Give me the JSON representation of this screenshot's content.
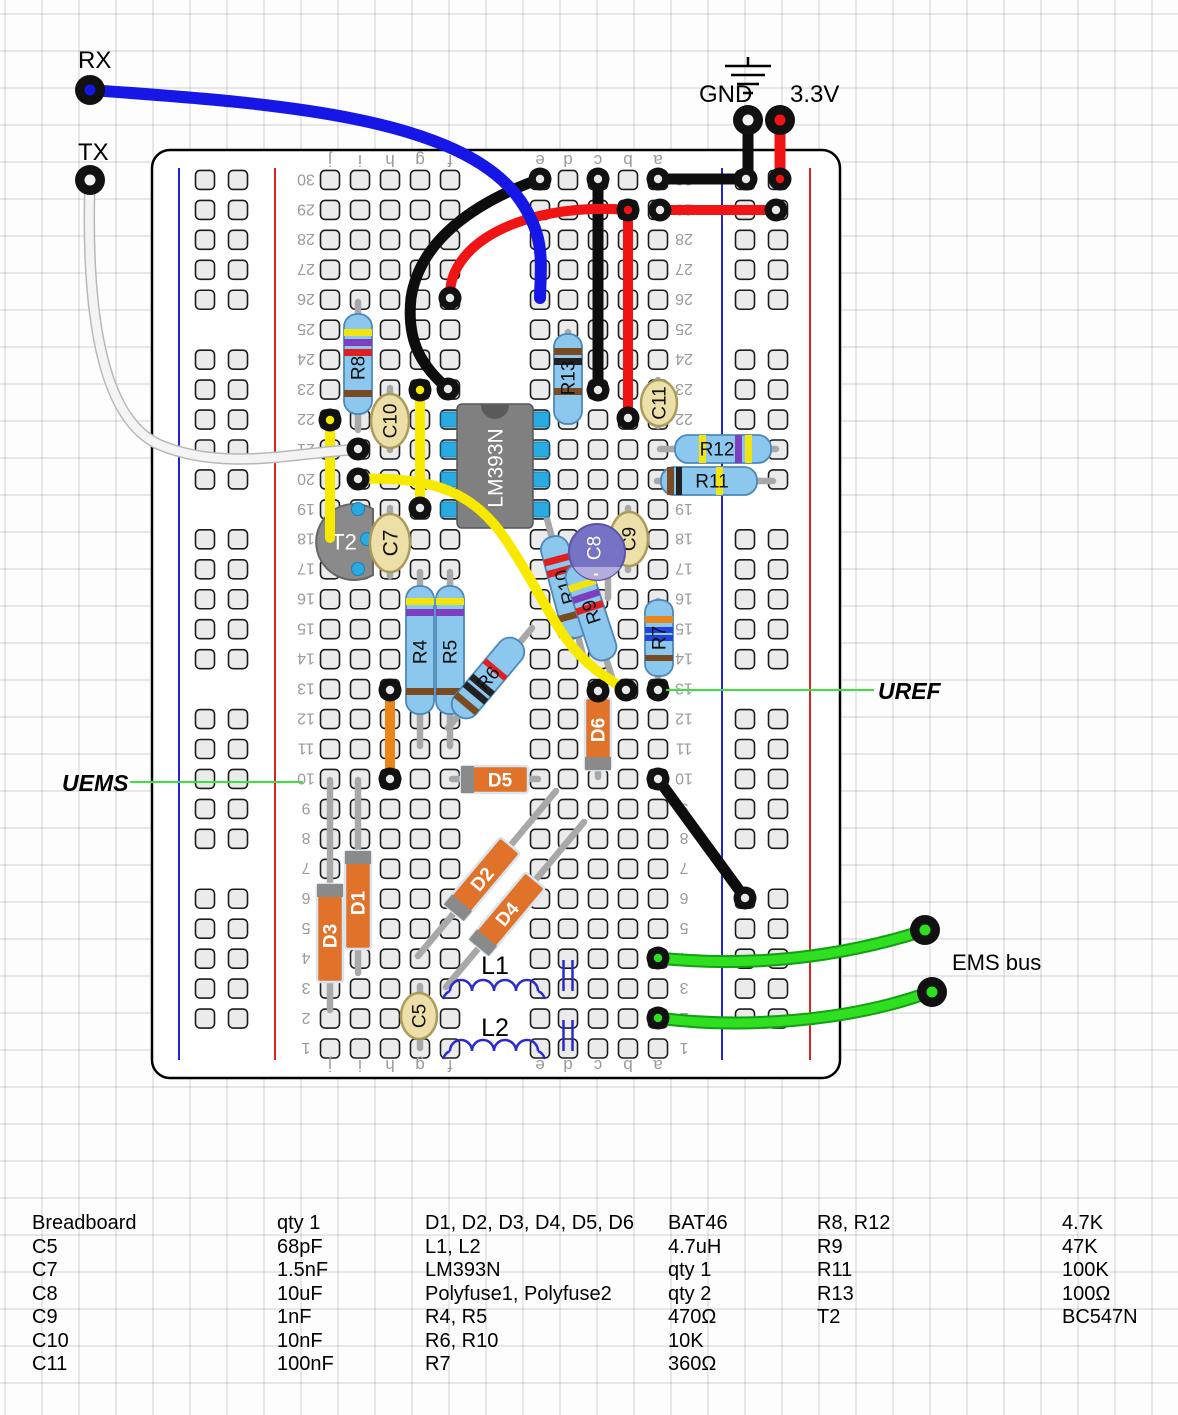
{
  "labels": {
    "rx": "RX",
    "tx": "TX",
    "gnd": "GND",
    "v33": "3.3V",
    "uref": "UREF",
    "uems": "UEMS",
    "ems_bus": "EMS bus"
  },
  "board": {
    "column_letters": [
      "j",
      "i",
      "h",
      "g",
      "f",
      "e",
      "d",
      "c",
      "b",
      "a"
    ],
    "row_count": 30
  },
  "components": {
    "R4": "R4",
    "R5": "R5",
    "R6": "R6",
    "R7": "R7",
    "R8": "R8",
    "R9": "R9",
    "R10": "R10",
    "R11": "R11",
    "R12": "R12",
    "R13": "R13",
    "C5": "C5",
    "C7": "C7",
    "C8": "C8",
    "C9": "C9",
    "C10": "C10",
    "C11": "C11",
    "D1": "D1",
    "D2": "D2",
    "D3": "D3",
    "D4": "D4",
    "D5": "D5",
    "D6": "D6",
    "L1": "L1",
    "L2": "L2",
    "T2": "T2",
    "IC": "LM393N",
    "minus": "-"
  },
  "colors": {
    "wire_blue": "#1616e6",
    "wire_black": "#0d0d0d",
    "wire_red": "#f01414",
    "wire_white": "#f4f4f4",
    "wire_yellow": "#f7ea00",
    "wire_green": "#2ee01f",
    "wire_orange": "#ea8618",
    "callout_line_green": "#3ae23a",
    "resistor_body": "#8cc7ee",
    "diode_body": "#e0722a",
    "cap_tan": "#ece0a8",
    "cap_electrolytic": "#7672c4",
    "ic_body": "#808080",
    "ic_pin": "#29abe2"
  },
  "parts_list": {
    "left": [
      {
        "name": "Breadboard",
        "value": "qty 1"
      },
      {
        "name": "C5",
        "value": "68pF"
      },
      {
        "name": "C7",
        "value": "1.5nF"
      },
      {
        "name": "C8",
        "value": "10uF"
      },
      {
        "name": "C9",
        "value": "1nF"
      },
      {
        "name": "C10",
        "value": "10nF"
      },
      {
        "name": "C11",
        "value": "100nF"
      }
    ],
    "middle": [
      {
        "name": "D1, D2, D3, D4, D5, D6",
        "value": "BAT46"
      },
      {
        "name": "L1, L2",
        "value": "4.7uH"
      },
      {
        "name": "LM393N",
        "value": "qty 1"
      },
      {
        "name": "Polyfuse1, Polyfuse2",
        "value": "qty 2"
      },
      {
        "name": "R4, R5",
        "value": "470Ω"
      },
      {
        "name": "R6, R10",
        "value": "10K"
      },
      {
        "name": "R7",
        "value": "360Ω"
      }
    ],
    "right": [
      {
        "name": "R8, R12",
        "value": "4.7K"
      },
      {
        "name": "R9",
        "value": "47K"
      },
      {
        "name": "R11",
        "value": "100K"
      },
      {
        "name": "R13",
        "value": "100Ω"
      },
      {
        "name": "T2",
        "value": "BC547N"
      }
    ]
  }
}
